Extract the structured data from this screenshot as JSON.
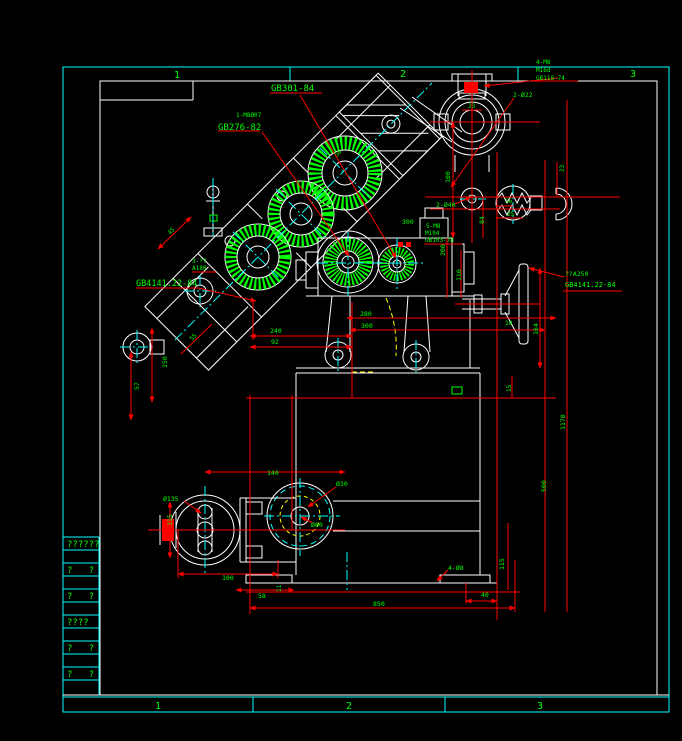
{
  "colors": {
    "bg": "#000000",
    "frame": "#00ffff",
    "line": "#ffffff",
    "dim": "#ff0000",
    "text": "#00ff00",
    "aux": "#ffff00"
  },
  "frame": {
    "zones_top": [
      {
        "n": "1",
        "x": 177,
        "y": 78
      },
      {
        "n": "2",
        "x": 403,
        "y": 77
      },
      {
        "n": "3",
        "x": 633,
        "y": 77
      }
    ],
    "zones_bottom": [
      {
        "n": "1",
        "x": 158,
        "y": 709
      },
      {
        "n": "2",
        "x": 349,
        "y": 709
      },
      {
        "n": "3",
        "x": 540,
        "y": 709
      }
    ]
  },
  "title_block": {
    "rows": [
      "??????",
      "?   ?",
      "?   ?",
      "????",
      "?   ?",
      "?   ?"
    ]
  },
  "labels": [
    {
      "t": "GB301-84",
      "x": 271,
      "y": 91,
      "s": 9
    },
    {
      "t": "1-M8Ø07",
      "x": 236,
      "y": 117,
      "s": 6
    },
    {
      "t": "GB276-82",
      "x": 218,
      "y": 130,
      "s": 9
    },
    {
      "t": "4-M8",
      "x": 536,
      "y": 64,
      "s": 6
    },
    {
      "t": "M16d",
      "x": 536,
      "y": 72,
      "s": 6
    },
    {
      "t": "GB118-74",
      "x": 536,
      "y": 80,
      "s": 6
    },
    {
      "t": "2-Ø22",
      "x": 513,
      "y": 97,
      "s": 6.5
    },
    {
      "t": "23",
      "x": 468,
      "y": 108,
      "s": 6
    },
    {
      "t": "2-Ø40",
      "x": 436,
      "y": 207,
      "s": 6.5
    },
    {
      "t": "100",
      "x": 450,
      "y": 183,
      "s": 6.5,
      "r": -90
    },
    {
      "t": "16",
      "x": 505,
      "y": 203,
      "s": 6
    },
    {
      "t": "25",
      "x": 507,
      "y": 216,
      "s": 6
    },
    {
      "t": "23",
      "x": 564,
      "y": 172,
      "s": 6,
      "r": -90
    },
    {
      "t": "300",
      "x": 402,
      "y": 224,
      "s": 6.5
    },
    {
      "t": "5-M8",
      "x": 426,
      "y": 228,
      "s": 6
    },
    {
      "t": "M104",
      "x": 425,
      "y": 235,
      "s": 6
    },
    {
      "t": "GB103-78",
      "x": 425,
      "y": 242,
      "s": 6
    },
    {
      "t": "200",
      "x": 445,
      "y": 256,
      "s": 6.5,
      "r": -90
    },
    {
      "t": "110",
      "x": 461,
      "y": 281,
      "s": 6.5,
      "r": -90
    },
    {
      "t": "84",
      "x": 484,
      "y": 224,
      "s": 6.5,
      "r": -90
    },
    {
      "t": "??A250",
      "x": 565,
      "y": 276,
      "s": 6.5
    },
    {
      "t": "GB4141.22-84",
      "x": 565,
      "y": 287,
      "s": 7
    },
    {
      "t": "3-??",
      "x": 192,
      "y": 263,
      "s": 6
    },
    {
      "t": "A180",
      "x": 192,
      "y": 270,
      "s": 6
    },
    {
      "t": "GB4141.22-84",
      "x": 136,
      "y": 286,
      "s": 8.5
    },
    {
      "t": "45",
      "x": 170,
      "y": 235,
      "s": 6,
      "r": -45
    },
    {
      "t": "50",
      "x": 337,
      "y": 157,
      "s": 6,
      "r": -45
    },
    {
      "t": "55",
      "x": 192,
      "y": 341,
      "s": 6,
      "r": -45
    },
    {
      "t": "240",
      "x": 270,
      "y": 333,
      "s": 6.5
    },
    {
      "t": "92",
      "x": 271,
      "y": 344,
      "s": 6.5
    },
    {
      "t": "280",
      "x": 360,
      "y": 316,
      "s": 6.5
    },
    {
      "t": "300",
      "x": 361,
      "y": 328,
      "s": 6.5
    },
    {
      "t": "150",
      "x": 167,
      "y": 368,
      "s": 6.5,
      "r": -90
    },
    {
      "t": "57",
      "x": 139,
      "y": 390,
      "s": 6.5,
      "r": -90
    },
    {
      "t": "164",
      "x": 538,
      "y": 335,
      "s": 6.5,
      "r": -90
    },
    {
      "t": "10",
      "x": 505,
      "y": 325,
      "s": 6
    },
    {
      "t": "15",
      "x": 511,
      "y": 392,
      "s": 6,
      "r": -90
    },
    {
      "t": "1170",
      "x": 565,
      "y": 430,
      "s": 6.5,
      "r": -90
    },
    {
      "t": "500",
      "x": 546,
      "y": 492,
      "s": 6.5,
      "r": -90
    },
    {
      "t": "Ø135",
      "x": 163,
      "y": 501,
      "s": 6.5
    },
    {
      "t": "115",
      "x": 172,
      "y": 526,
      "s": 6.5,
      "r": -90
    },
    {
      "t": "140",
      "x": 267,
      "y": 475,
      "s": 6.5
    },
    {
      "t": "Ø30",
      "x": 336,
      "y": 486,
      "s": 6.5
    },
    {
      "t": "Ø60",
      "x": 311,
      "y": 527,
      "s": 6.5
    },
    {
      "t": "100",
      "x": 222,
      "y": 580,
      "s": 6.5
    },
    {
      "t": "58",
      "x": 258,
      "y": 598,
      "s": 6.5
    },
    {
      "t": "11",
      "x": 281,
      "y": 592,
      "s": 6,
      "r": -90
    },
    {
      "t": "850",
      "x": 373,
      "y": 606,
      "s": 6.5
    },
    {
      "t": "40",
      "x": 481,
      "y": 597,
      "s": 6.5
    },
    {
      "t": "4-Ø8",
      "x": 448,
      "y": 570,
      "s": 6.5
    },
    {
      "t": "115",
      "x": 504,
      "y": 570,
      "s": 6.5,
      "r": -90
    }
  ]
}
